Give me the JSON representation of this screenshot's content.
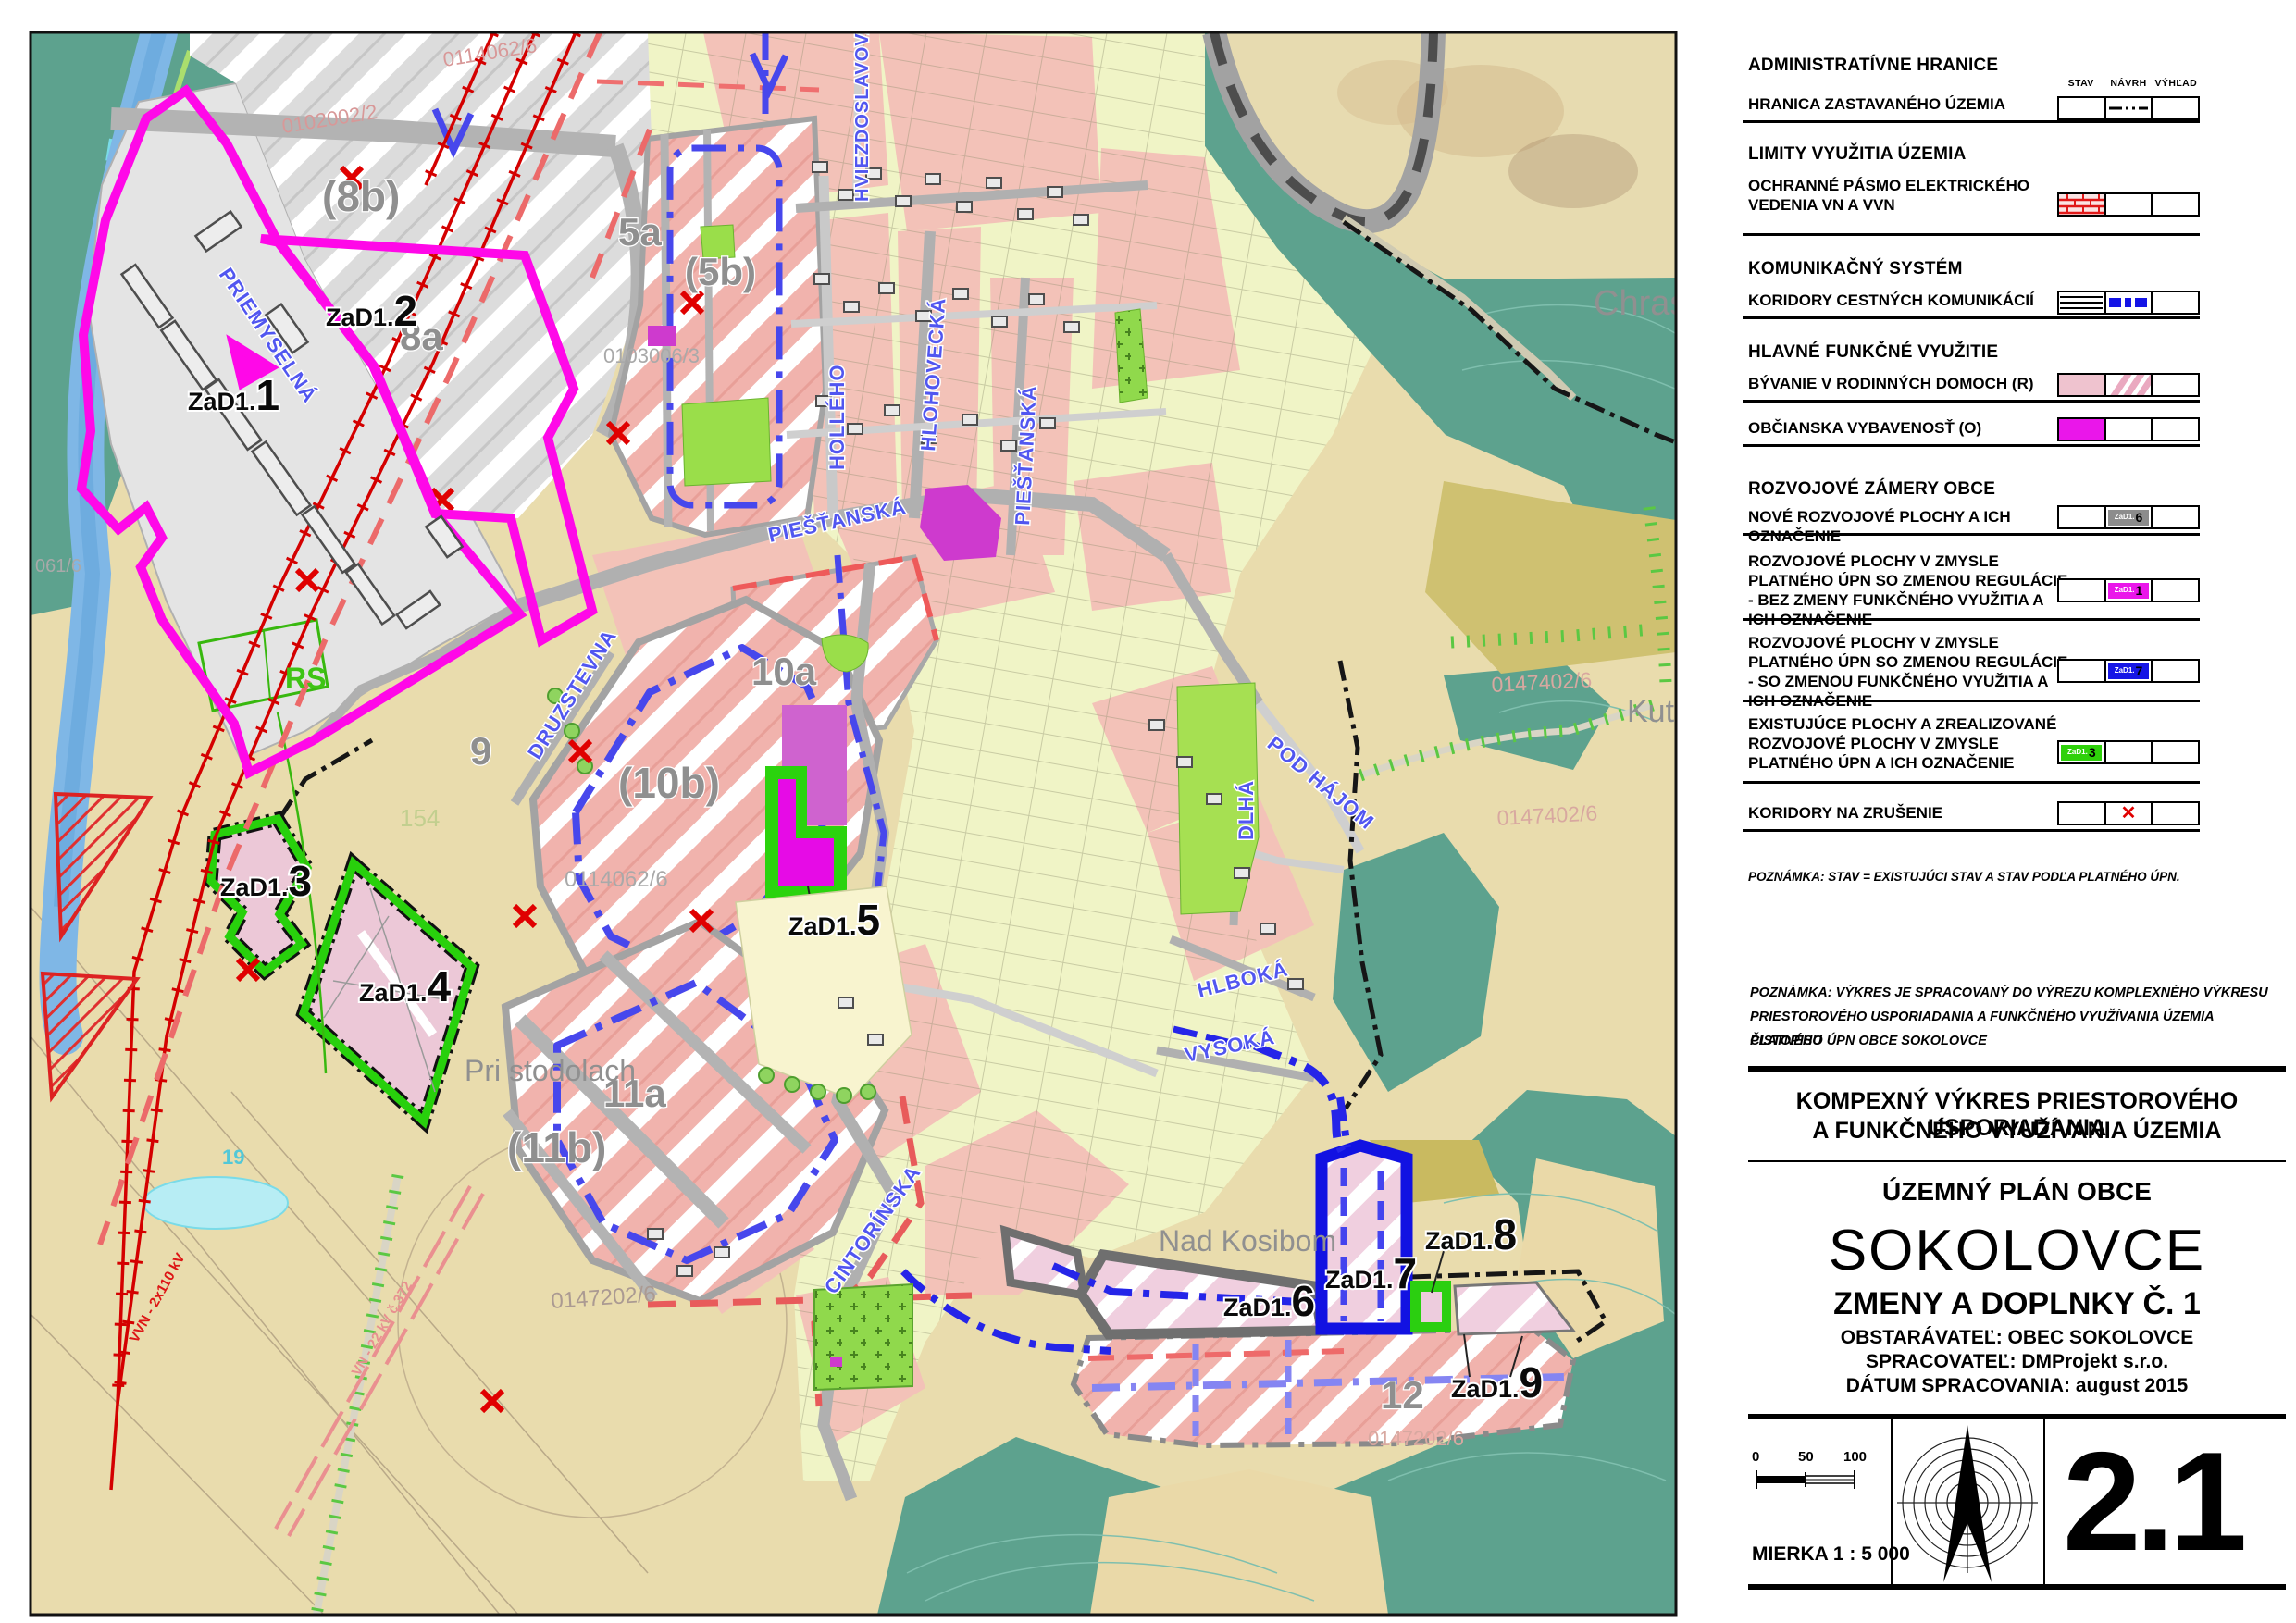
{
  "map_labels": {
    "p0114062_top": "0114062/6",
    "p0102002": "0102002/2",
    "z8b": "(8b)",
    "z8a": "8a",
    "z5a": "5a",
    "z5b": "(5b)",
    "p0103006": "0103006/3",
    "z9": "9",
    "z10a": "10a",
    "z10b": "(10b)",
    "z11a": "11a",
    "z11b": "(11b)",
    "z12": "12",
    "z154": "154",
    "z19": "19",
    "p0114062_mid": "0114062/6",
    "p0147202_w": "0147202/6",
    "p0147202_se": "0147202/6",
    "p0147402_a": "0147402/6",
    "p0147402_b": "0147402/6",
    "p061": "061/6",
    "rs": "RS",
    "chrast": "Chrast",
    "kutik": "Kutik",
    "pri_stodolach": "Pri stodolach",
    "nad_kosibom": "Nad Kosibom",
    "vvn": "VVN - 2x110 kV",
    "vn": "VN - 22 kV č.372",
    "st_priemyselna": "PRIEMYSELNÁ",
    "st_piestanska_1": "PIEŠŤANSKÁ",
    "st_piestanska_2": "PIEŠŤANSKÁ",
    "st_holleho": "HOLLÉHO",
    "st_hviezdoslavova": "HVIEZDOSLAVOVA",
    "st_hlohovecka": "HLOHOVECKÁ",
    "st_druzstevna": "DRUZSTEVNA",
    "st_cintorinska": "CINTORÍNSKA",
    "st_pod_hajom": "POD HÁJOM",
    "st_dlha": "DLHÁ",
    "st_hlboka": "HLBOKÁ",
    "st_vysoka": "VYSOKÁ"
  },
  "zad": {
    "prefix": "ZaD1.",
    "nums": [
      "1",
      "2",
      "3",
      "4",
      "5",
      "6",
      "7",
      "8",
      "9"
    ]
  },
  "legend": {
    "columns": [
      "STAV",
      "NÁVRH",
      "VÝHĽAD"
    ],
    "sections": [
      {
        "title": "ADMINISTRATÍVNE HRANICE"
      },
      {
        "title": "LIMITY VYUŽITIA ÚZEMIA"
      },
      {
        "title": "KOMUNIKAČNÝ SYSTÉM"
      },
      {
        "title": "HLAVNÉ FUNKČNÉ VYUŽITIE"
      },
      {
        "title": "ROZVOJOVÉ ZÁMERY OBCE"
      }
    ],
    "items": [
      {
        "label": "HRANICA ZASTAVANÉHO ÚZEMIA"
      },
      {
        "label": "OCHRANNÉ PÁSMO ELEKTRICKÉHO VEDENIA VN A VVN"
      },
      {
        "label": "KORIDORY CESTNÝCH KOMUNIKÁCIÍ"
      },
      {
        "label": "BÝVANIE V RODINNÝCH DOMOCH (R)"
      },
      {
        "label": "OBČIANSKA VYBAVENOSŤ (O)"
      },
      {
        "label": "NOVÉ ROZVOJOVÉ PLOCHY A ICH OZNAČENIE",
        "chip_prefix": "ZaD1.",
        "chip_num": "6"
      },
      {
        "label": "ROZVOJOVÉ PLOCHY V ZMYSLE PLATNÉHO ÚPN SO ZMENOU REGULÁCIE - BEZ ZMENY FUNKČNÉHO VYUŽITIA A ICH OZNAČENIE",
        "chip_prefix": "ZaD1.",
        "chip_num": "1"
      },
      {
        "label": "ROZVOJOVÉ PLOCHY V ZMYSLE PLATNÉHO ÚPN SO ZMENOU REGULÁCIE - SO ZMENOU FUNKČNÉHO VYUŽITIA A ICH OZNAČENIE",
        "chip_prefix": "ZaD1.",
        "chip_num": "7"
      },
      {
        "label": "EXISTUJÚCE PLOCHY A ZREALIZOVANÉ ROZVOJOVÉ PLOCHY V ZMYSLE PLATNÉHO ÚPN A ICH OZNAČENIE",
        "chip_prefix": "ZaD1.",
        "chip_num": "3"
      },
      {
        "label": "KORIDORY NA ZRUŠENIE"
      }
    ],
    "note": "POZNÁMKA: STAV = EXISTUJÚCI STAV A STAV PODĽA PLATNÉHO ÚPN."
  },
  "titleblock": {
    "note_lines": [
      "POZNÁMKA: VÝKRES  JE SPRACOVANÝ DO VÝREZU KOMPLEXNÉHO VÝKRESU",
      "PRIESTOROVÉHO USPORIADANIA A FUNKČNÉHO VYUŽÍVANIA ÚZEMIA ČISTOPISU",
      "PLATNÉHO ÚPN OBCE SOKOLOVCE"
    ],
    "heading1": "KOMPEXNÝ VÝKRES PRIESTOROVÉHO USPORIADANIA",
    "heading2": "A FUNKČNÉHO VYUŽÍVANIA ÚZEMIA",
    "plan_type": "ÚZEMNÝ PLÁN OBCE",
    "municipality": "SOKOLOVCE",
    "amendment": "ZMENY A DOPLNKY Č. 1",
    "client": "OBSTARÁVATEĽ: OBEC SOKOLOVCE",
    "author": "SPRACOVATEĽ: DMProjekt s.r.o.",
    "date": "DÁTUM  SPRACOVANIA: august 2015",
    "scale_ticks": [
      "0",
      "50",
      "100"
    ],
    "scale_text": "MIERKA 1 : 5 000",
    "sheet_number": "2.1"
  },
  "colors": {
    "magenta_outline": "#ff08e8",
    "civic_magenta": "#ea16ea",
    "dev_blue": "#1616e6",
    "existing_green": "#2ed10a",
    "new_gray": "#8c8c8c",
    "corridor_red": "#e00000",
    "residential_pink": "#efc3cf"
  }
}
